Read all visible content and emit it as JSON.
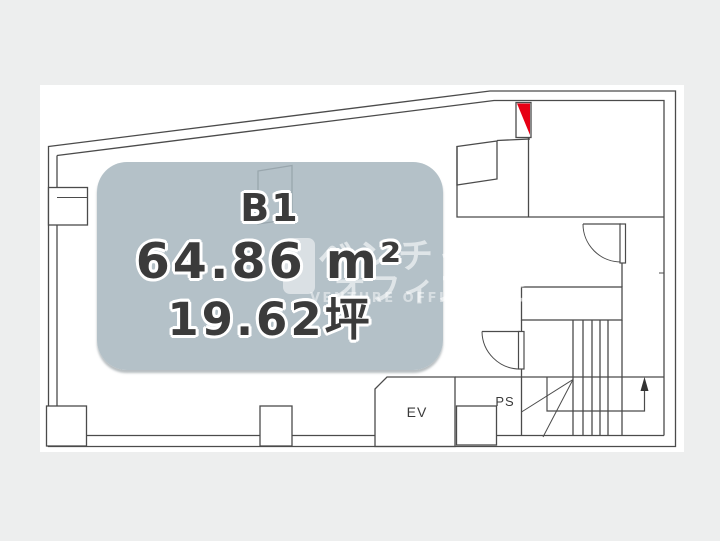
{
  "floorplan": {
    "unit_label": {
      "floor": "B1",
      "area_m2": "64.86 m²",
      "area_tsubo": "19.62坪"
    },
    "rooms": {
      "elevator_label": "EV",
      "pipe_space_label": "PS"
    },
    "colors": {
      "entrance_marker": "#e60014",
      "overlay_fill": "#b4c1c7",
      "line": "#4b4b4b",
      "page_background": "#edeeee"
    }
  },
  "watermark": {
    "line1": "ベンチャー",
    "line2": "オフィスナビ",
    "line3": "VENTURE OFFICE NAVI"
  }
}
